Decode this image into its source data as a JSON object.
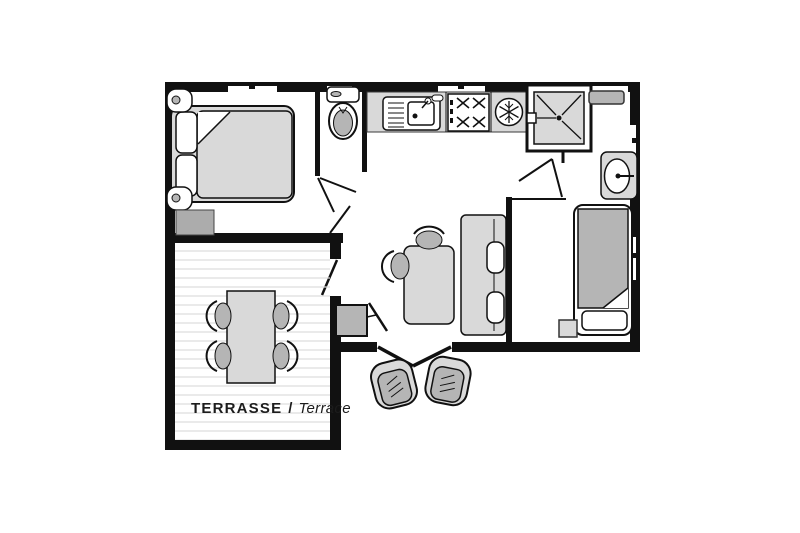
{
  "plan": {
    "background": "#ffffff",
    "colors": {
      "wall": "#111111",
      "furniture_light": "#d9d9d9",
      "furniture_mid": "#b5b5b5",
      "deck_line": "#dcdcdc",
      "text": "#1c1c1c"
    },
    "terrace_label": {
      "fr": "TERRASSE",
      "separator": "/",
      "en": "Terrace"
    },
    "rooms": [
      {
        "id": "bedroom-master",
        "furniture": [
          "double-bed",
          "two-pillows",
          "nightstand-lamp",
          "nightstand-lamp",
          "storage-bench"
        ]
      },
      {
        "id": "wc",
        "furniture": [
          "toilet"
        ]
      },
      {
        "id": "kitchen",
        "furniture": [
          "sink-drainer",
          "hob-4-burners",
          "fridge"
        ]
      },
      {
        "id": "shower-room",
        "furniture": [
          "shower-cabin",
          "washbasin",
          "vent-shelf"
        ]
      },
      {
        "id": "bedroom-single",
        "furniture": [
          "single-bed",
          "pillow",
          "bedside-table"
        ]
      },
      {
        "id": "living-dining",
        "furniture": [
          "dining-table",
          "chair",
          "chair",
          "sofa-bench",
          "two-cushions",
          "tv-stand",
          "tv"
        ]
      },
      {
        "id": "terrace",
        "furniture": [
          "outdoor-table",
          "four-chairs"
        ]
      },
      {
        "id": "exterior",
        "furniture": [
          "outdoor-armchair",
          "outdoor-armchair"
        ]
      }
    ]
  }
}
